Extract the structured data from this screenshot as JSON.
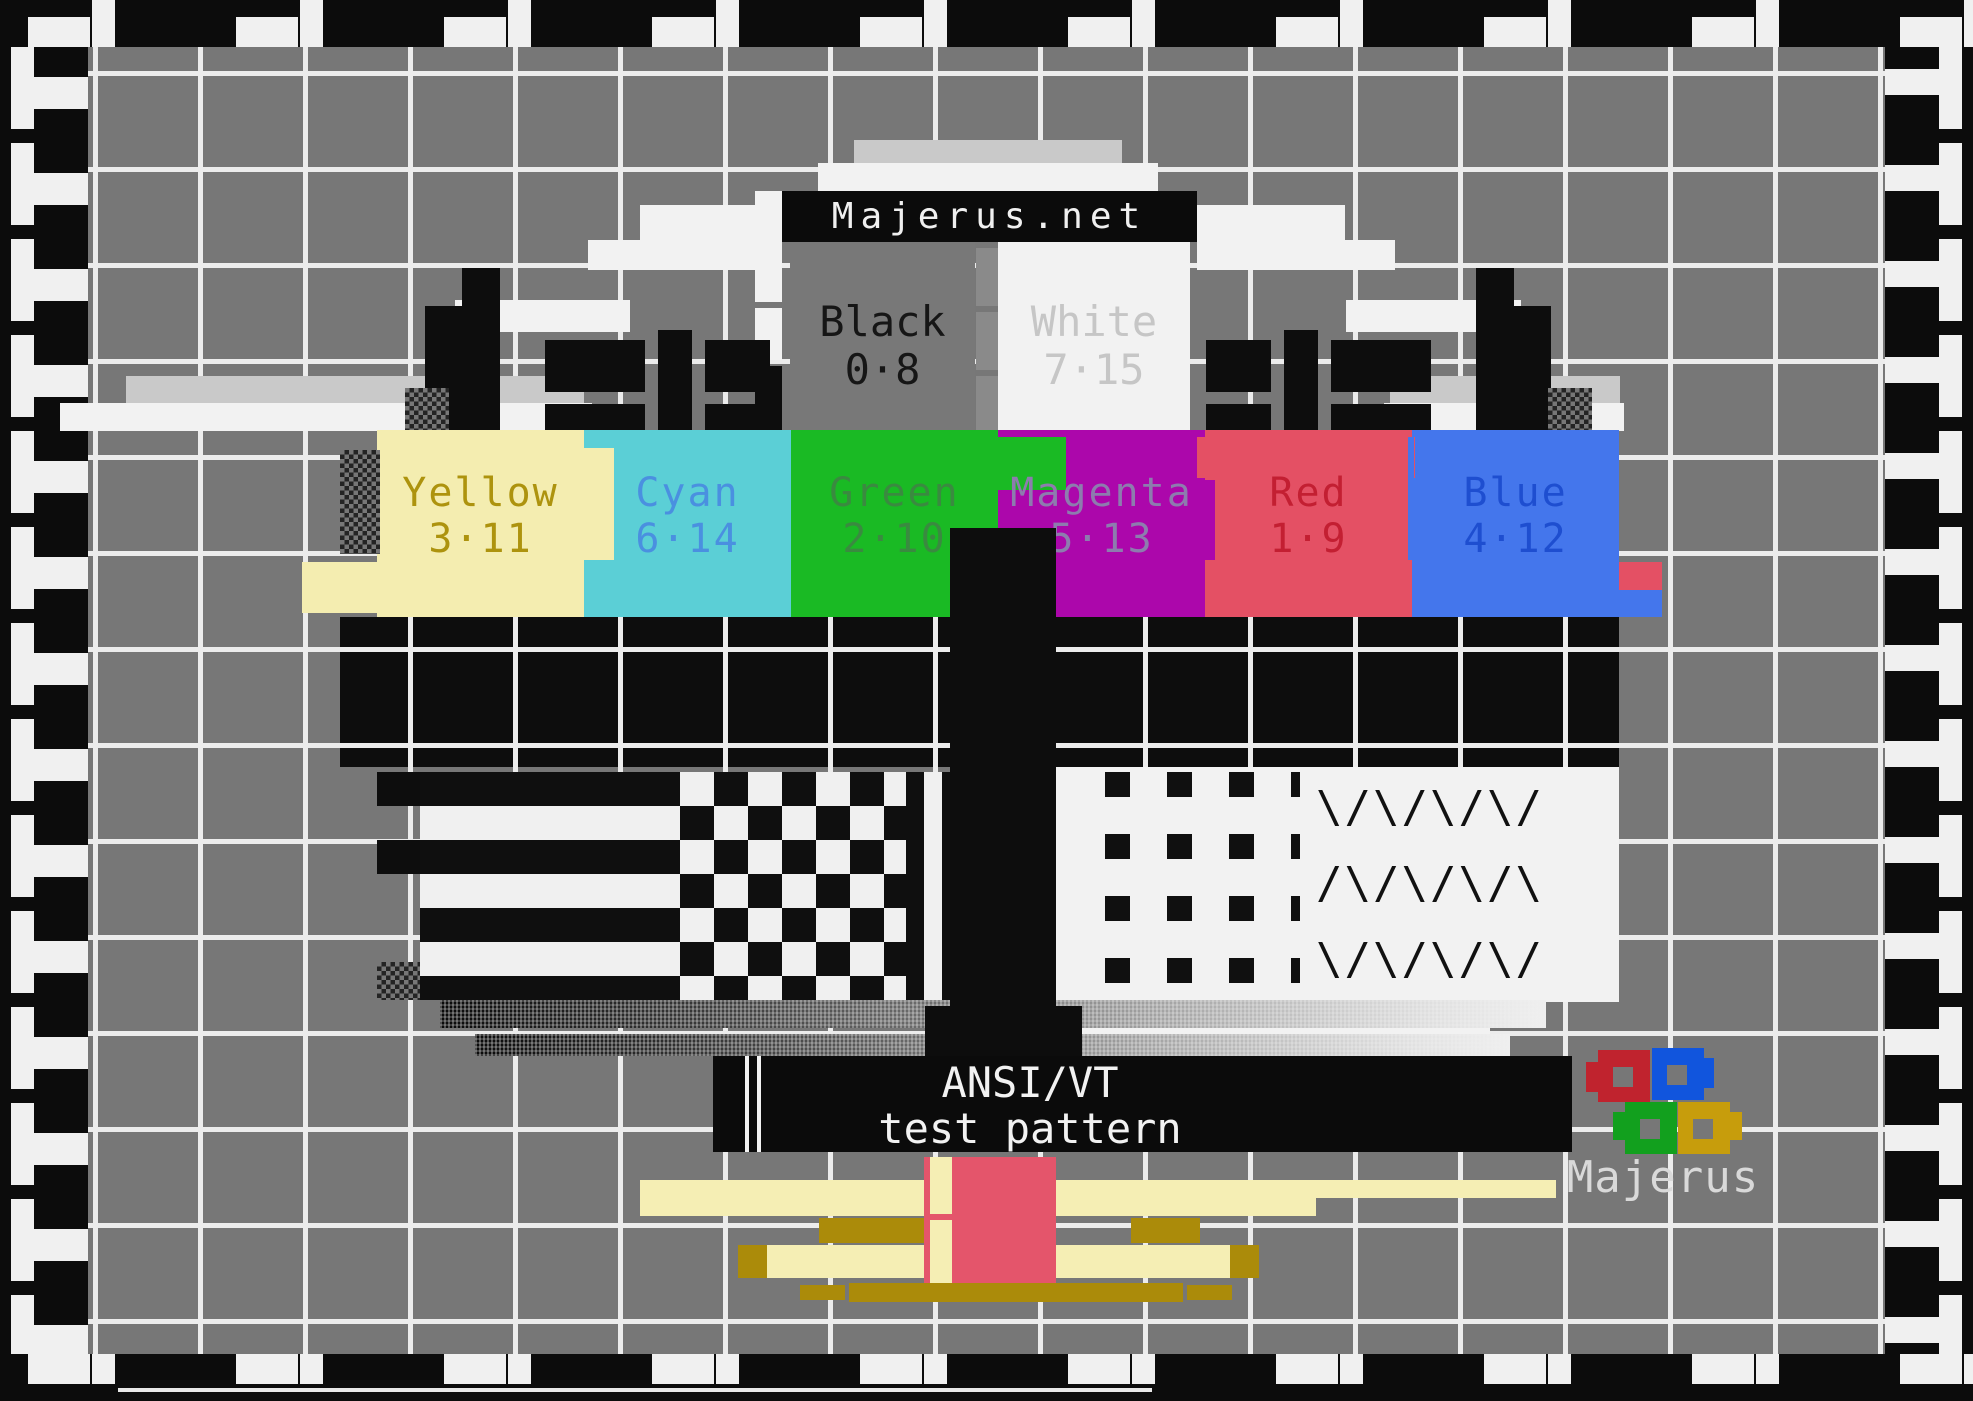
{
  "screen": {
    "width": 1973,
    "height": 1401,
    "description": "ANSI/VT terminal colour test pattern"
  },
  "title_bar": {
    "label": "Majerus.net"
  },
  "reference_cells": {
    "black": {
      "name": "Black",
      "code": "0·8",
      "bg": "#787878",
      "fg": "#161616"
    },
    "white": {
      "name": "White",
      "code": "7·15",
      "bg": "#f2f2f2",
      "fg": "#c6c6c6"
    }
  },
  "color_bars": [
    {
      "name": "Yellow",
      "code": "3·11",
      "bg": "#f4edb0",
      "fg": "#ad930e"
    },
    {
      "name": "Cyan",
      "code": "6·14",
      "bg": "#5bcfd6",
      "fg": "#4a90e0"
    },
    {
      "name": "Green",
      "code": "2·10",
      "bg": "#1aba24",
      "fg": "#3a8a40"
    },
    {
      "name": "Magenta",
      "code": "5·13",
      "bg": "#ac07ab",
      "fg": "#8d7cae"
    },
    {
      "name": "Red",
      "code": "1·9",
      "bg": "#e45064",
      "fg": "#c31f32"
    },
    {
      "name": "Blue",
      "code": "4·12",
      "bg": "#4476ec",
      "fg": "#1e4ed0"
    }
  ],
  "caption_bar": {
    "line1": "ANSI/VT",
    "line2": "test pattern"
  },
  "logo": {
    "label": "Majerus",
    "text_color": "#d9d9d9",
    "squares": [
      {
        "name": "red",
        "color": "#c0232e"
      },
      {
        "name": "blue",
        "color": "#1155dd"
      },
      {
        "name": "green",
        "color": "#12a01e"
      },
      {
        "name": "gold",
        "color": "#c79d0c"
      }
    ]
  },
  "patterns": {
    "diagonal_row_a": "\\/\\/\\/\\/",
    "diagonal_row_b": "/\\/\\/\\/\\"
  },
  "colors": {
    "field_gray": "#777777",
    "grid_line": "#ececec",
    "border_black": "#0c0c0c",
    "white": "#f2f2f2",
    "light_gray": "#c9c9c9",
    "pale_yellow": "#f5eeb4",
    "gold": "#ab8b0a",
    "red_block": "#e4556b"
  }
}
